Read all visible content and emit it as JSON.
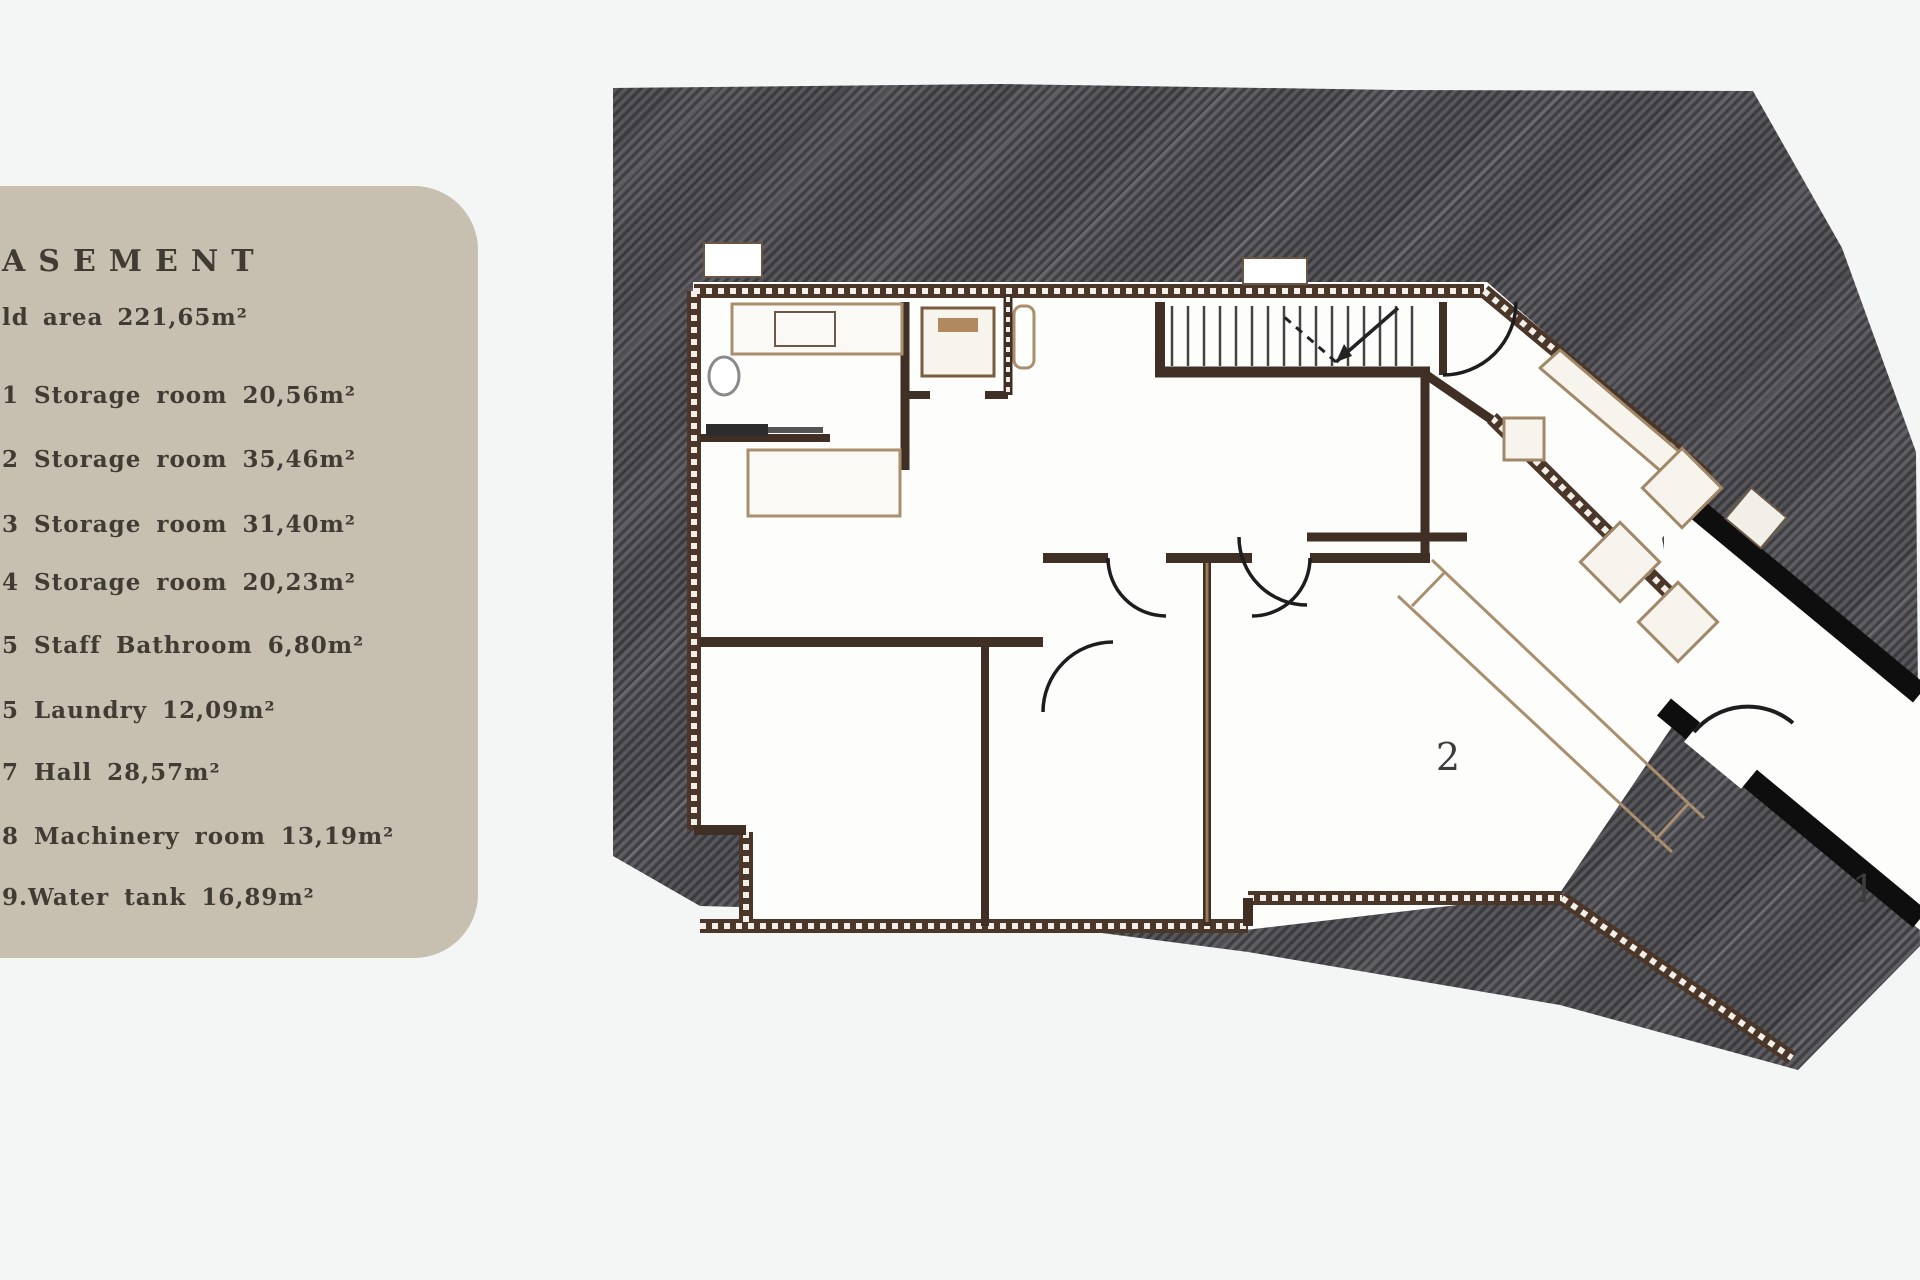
{
  "legend": {
    "title": "ASEMENT",
    "subtitle": "ld area 221,65m²",
    "panel_color": "#c7bfb0",
    "text_color": "#413c33",
    "items": [
      "1 Storage room 20,56m²",
      "2 Storage room 35,46m²",
      "3 Storage room 31,40m²",
      "4 Storage room 20,23m²",
      "5 Staff Bathroom 6,80m²",
      "5 Laundry 12,09m²",
      "7 Hall 28,57m²",
      "8 Machinery room 13,19m²",
      "9.Water tank 16,89m²"
    ]
  },
  "plan": {
    "room_labels": [
      {
        "text": "2"
      },
      {
        "text": "1"
      }
    ],
    "colors": {
      "background": "#f4f5f5",
      "hatch_base": "#4c4c50",
      "hatch_light": "#606065",
      "hatch_dark": "#38383c",
      "floor_white": "#fdfdfc",
      "exterior_wall": "#4a3729",
      "wall_dot": "#f2efe8",
      "interior_wall": "#3f2f24",
      "furniture_line": "#a08868",
      "wing_wall": "#0e0e0e"
    }
  }
}
